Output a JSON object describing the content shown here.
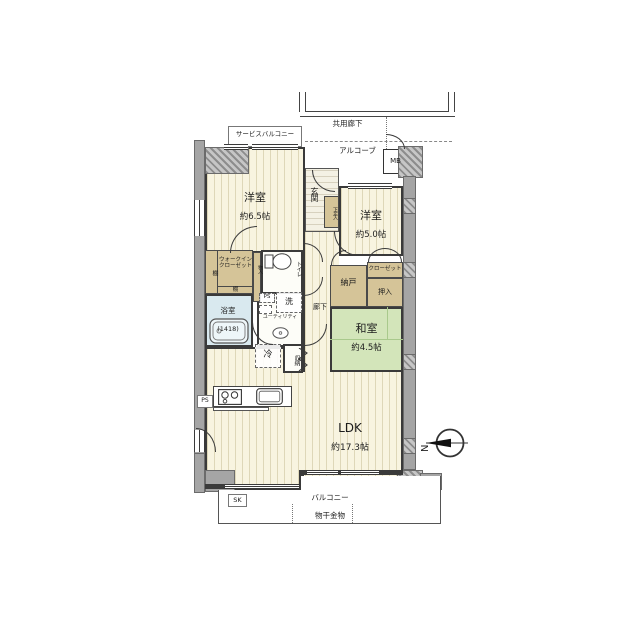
{
  "rooms": {
    "western_6_5": {
      "name": "洋室",
      "size": "約6.5帖"
    },
    "western_5_0": {
      "name": "洋室",
      "size": "約5.0帖"
    },
    "japanese_4_5": {
      "name": "和室",
      "size": "約4.5帖"
    },
    "ldk": {
      "name": "LDK",
      "size": "約17.3帖"
    },
    "bathroom": {
      "name": "浴室",
      "size": "(1418)"
    },
    "entrance": "玄関",
    "hallway": "廊下",
    "utility": "ユーティリティ",
    "walk_in_closet": "ウォークインクローゼット",
    "storage_room": "納戸",
    "closet": "クローゼット",
    "oshiire": "押入",
    "toilet": "トイレ"
  },
  "fixtures": {
    "shelf": "棚",
    "washbasin": "洗",
    "refrigerator": "冷",
    "storage": "収納",
    "shoe_cabinet": "下足入",
    "small_storage": "物入",
    "pipe_space": "PS",
    "meter_box": "MB",
    "slop_sink": "SK"
  },
  "exterior": {
    "common_corridor": "共用廊下",
    "alcove": "アルコーブ",
    "service_balcony": "サービスバルコニー",
    "balcony": "バルコニー",
    "laundry_hardware": "物干金物"
  },
  "compass": {
    "north": "N"
  },
  "colors": {
    "floor_cream": "#f8f4e0",
    "closet_tan": "#d5c498",
    "tatami_green": "#d3e5ba",
    "bath_blue": "#d9e9ef",
    "wall_gray": "#a5a5a5"
  }
}
